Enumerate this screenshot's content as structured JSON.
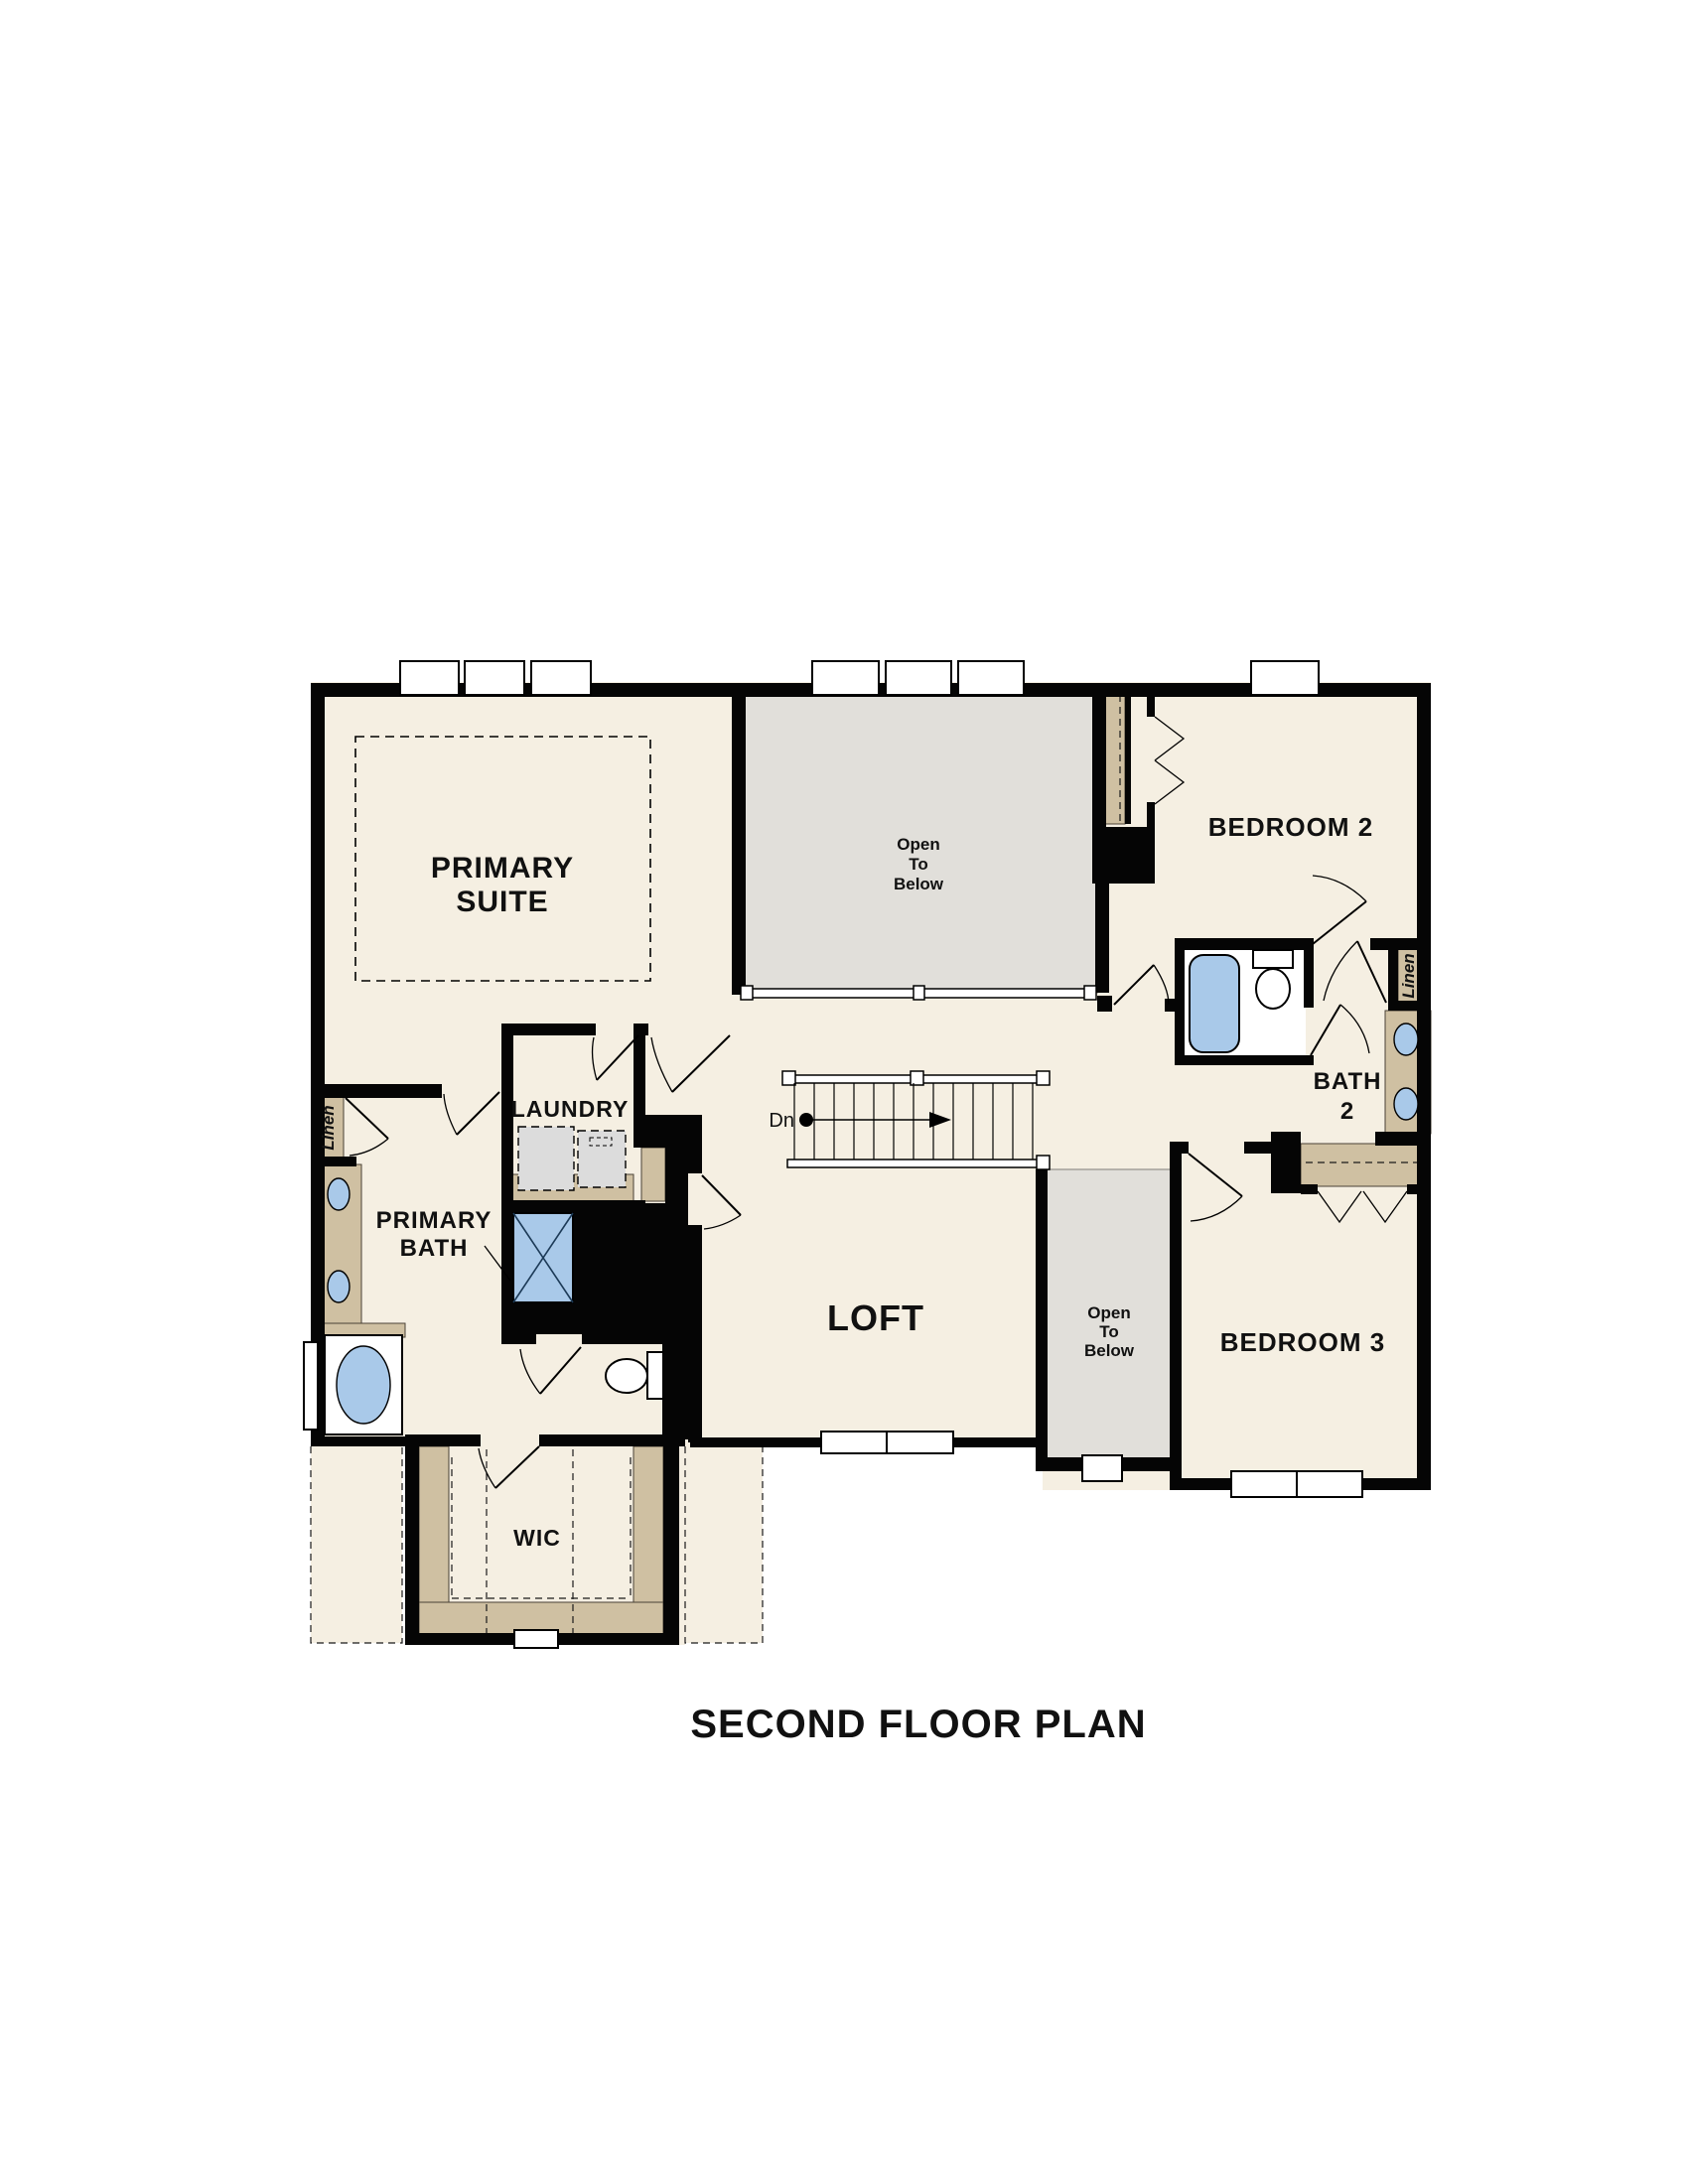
{
  "title": "SECOND FLOOR PLAN",
  "rooms": {
    "primary_suite": {
      "line1": "PRIMARY",
      "line2": "SUITE"
    },
    "open_to_below_top": {
      "line1": "Open",
      "line2": "To",
      "line3": "Below"
    },
    "bedroom2": {
      "label": "BEDROOM 2"
    },
    "bath2": {
      "line1": "BATH",
      "line2": "2"
    },
    "linen_right": {
      "label": "Linen"
    },
    "linen_left": {
      "label": "Linen"
    },
    "laundry": {
      "label": "LAUNDRY"
    },
    "primary_bath": {
      "line1": "PRIMARY",
      "line2": "BATH"
    },
    "loft": {
      "label": "LOFT"
    },
    "open_to_below_center": {
      "line1": "Open",
      "line2": "To",
      "line3": "Below"
    },
    "bedroom3": {
      "label": "BEDROOM 3"
    },
    "wic": {
      "label": "WIC"
    }
  },
  "stairs": {
    "down_label": "Dn"
  },
  "colors": {
    "background": "#ffffff",
    "floor_beige": "#f5efe2",
    "open_to_below_gray": "#e1dfda",
    "closet_tan": "#cfc0a2",
    "wall_black": "#050505",
    "fixture_blue": "#a9c9e9",
    "appliance_gray": "#dcdcdc",
    "text": "#111111"
  }
}
